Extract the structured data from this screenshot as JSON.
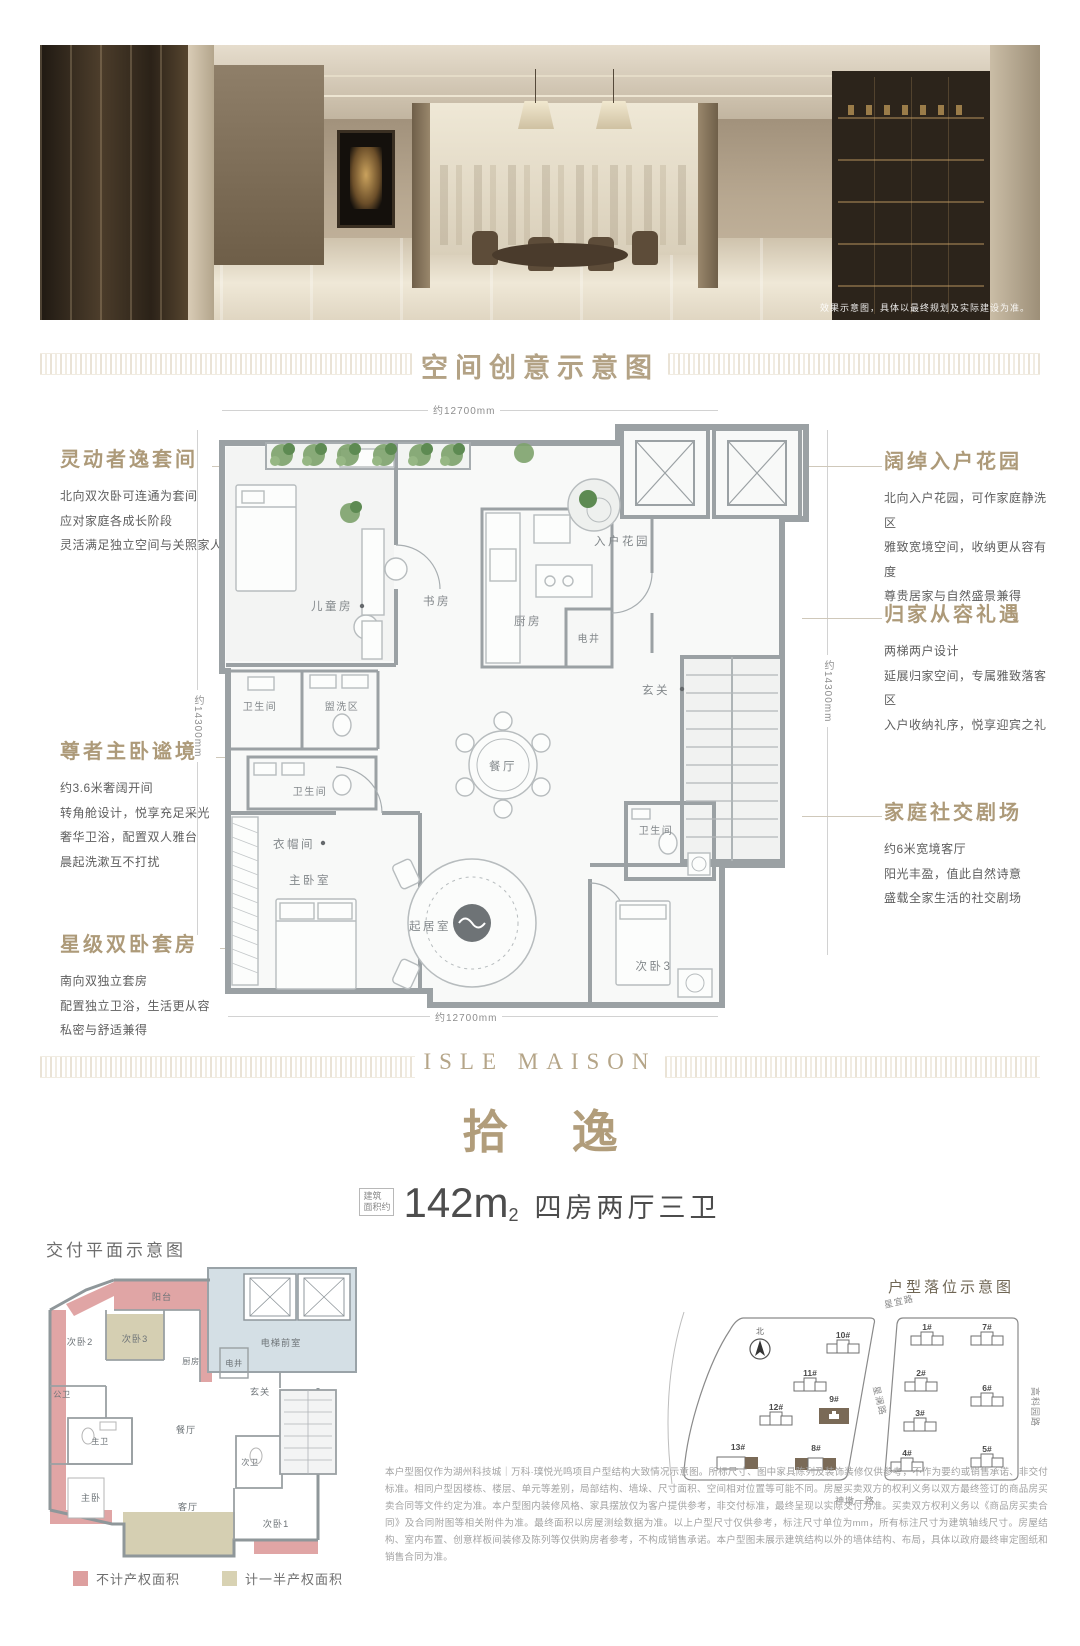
{
  "photo": {
    "caption": "效果示意图，具体以最终规划及实际建设为准。"
  },
  "section_banner": {
    "title": "空间创意示意图"
  },
  "floorplan": {
    "dims": {
      "top": "约12700mm",
      "bottom": "约12700mm",
      "left": "约14300mm",
      "right": "约14300mm"
    },
    "rooms": {
      "children": "儿童房",
      "study": "书房",
      "kitchen": "厨房",
      "shaft": "电井",
      "garden": "入户花园",
      "foyer": "玄关",
      "bath1": "卫生间",
      "wash": "盥洗区",
      "bath2": "卫生间",
      "dining": "餐厅",
      "bath3": "卫生间",
      "cloak": "衣帽间",
      "master": "主卧室",
      "living": "起居室",
      "bed3": "次卧3"
    },
    "annotations_left": [
      {
        "title": "灵动者逸套间",
        "lines": [
          "北向双次卧可连通为套间",
          "应对家庭各成长阶段",
          "灵活满足独立空间与关照家人"
        ]
      },
      {
        "title": "尊者主卧谧境",
        "lines": [
          "约3.6米奢阔开间",
          "转角舱设计，悦享充足采光",
          "奢华卫浴，配置双人雅台",
          "晨起洗漱互不打扰"
        ]
      },
      {
        "title": "星级双卧套房",
        "lines": [
          "南向双独立套房",
          "配置独立卫浴，生活更从容",
          "私密与舒适兼得"
        ]
      }
    ],
    "annotations_right": [
      {
        "title": "阔绰入户花园",
        "lines": [
          "北向入户花园，可作家庭静洗区",
          "雅致宽境空间，收纳更从容有度",
          "尊贵居家与自然盛景兼得"
        ]
      },
      {
        "title": "归家从容礼遇",
        "lines": [
          "两梯两户设计",
          "延展归家空间，专属雅致落客区",
          "入户收纳礼序，悦享迎宾之礼"
        ]
      },
      {
        "title": "家庭社交剧场",
        "lines": [
          "约6米宽境客厅",
          "阳光丰盈，值此自然诗意",
          "盛载全家生活的社交剧场"
        ]
      }
    ]
  },
  "brand": {
    "name": "ISLE MAISON"
  },
  "unit": {
    "name": "拾 逸",
    "area_prefix_top": "建筑",
    "area_prefix_bottom": "面积约",
    "area_value": "142m",
    "area_sup": "2",
    "layout": "四房两厅三卫"
  },
  "delivery_plan": {
    "heading": "交付平面示意图",
    "rooms": {
      "balcony": "阳台",
      "bed2": "次卧2",
      "bed3": "次卧3",
      "kitchen": "厨房",
      "shaft": "电井",
      "lobby": "电梯前室",
      "foyer": "玄关",
      "pub_bath": "公卫",
      "master_bath": "主卫",
      "dining": "餐厅",
      "master": "主卧",
      "living": "客厅",
      "sec_bath": "次卫",
      "bed1": "次卧1"
    },
    "legend": [
      {
        "label": "不计产权面积",
        "color": "#dd9f9f"
      },
      {
        "label": "计一半产权面积",
        "color": "#d8d2b3"
      }
    ]
  },
  "site_plan": {
    "heading": "户型落位示意图",
    "north": "北",
    "roads": {
      "top": "星宜路",
      "middle": "星澜路",
      "right": "高科园路",
      "bottom": "神墩一路"
    },
    "buildings": [
      {
        "id": "10#"
      },
      {
        "id": "11#"
      },
      {
        "id": "12#"
      },
      {
        "id": "9#",
        "highlight": true
      },
      {
        "id": "13#"
      },
      {
        "id": "8#"
      },
      {
        "id": "1#"
      },
      {
        "id": "7#"
      },
      {
        "id": "2#"
      },
      {
        "id": "6#"
      },
      {
        "id": "3#"
      },
      {
        "id": "4#"
      },
      {
        "id": "5#"
      }
    ]
  },
  "disclaimer": {
    "lines": [
      "本户型图仅作为湖州科技城｜万科·璞悦光鸣项目户型结构大致情况示意图。所标尺寸、图中家具陈列及装饰装修仅供参考，不作为要约或销售承诺、非交付标准。相",
      "同户型因楼栋、楼层、单元等差别，局部结构、墙垛、尺寸面积、空间相对位置等可能不同。房屋买卖双方的权利义务以双方最终签订的商品房买卖合同等文件约定为",
      "准。本户型图内装修风格、家具摆放仅为客户提供参考，非交付标准，最终呈现以实际交付为准。买卖双方权利义务以《商品房买卖合同》及合同附图等相关附件为准。",
      "最终面积以房屋测绘数据为准。以上户型尺寸仅供参考，标注尺寸单位为mm，所有标注尺寸为建筑轴线尺寸。房屋结构、室内布置、创意样板间装修及陈列等仅",
      "供购房者参考，不构成销售承诺。本户型图未展示建筑结构以外的墙体结构、布局，具体以政府最终审定图纸和销售合同为准。"
    ]
  }
}
